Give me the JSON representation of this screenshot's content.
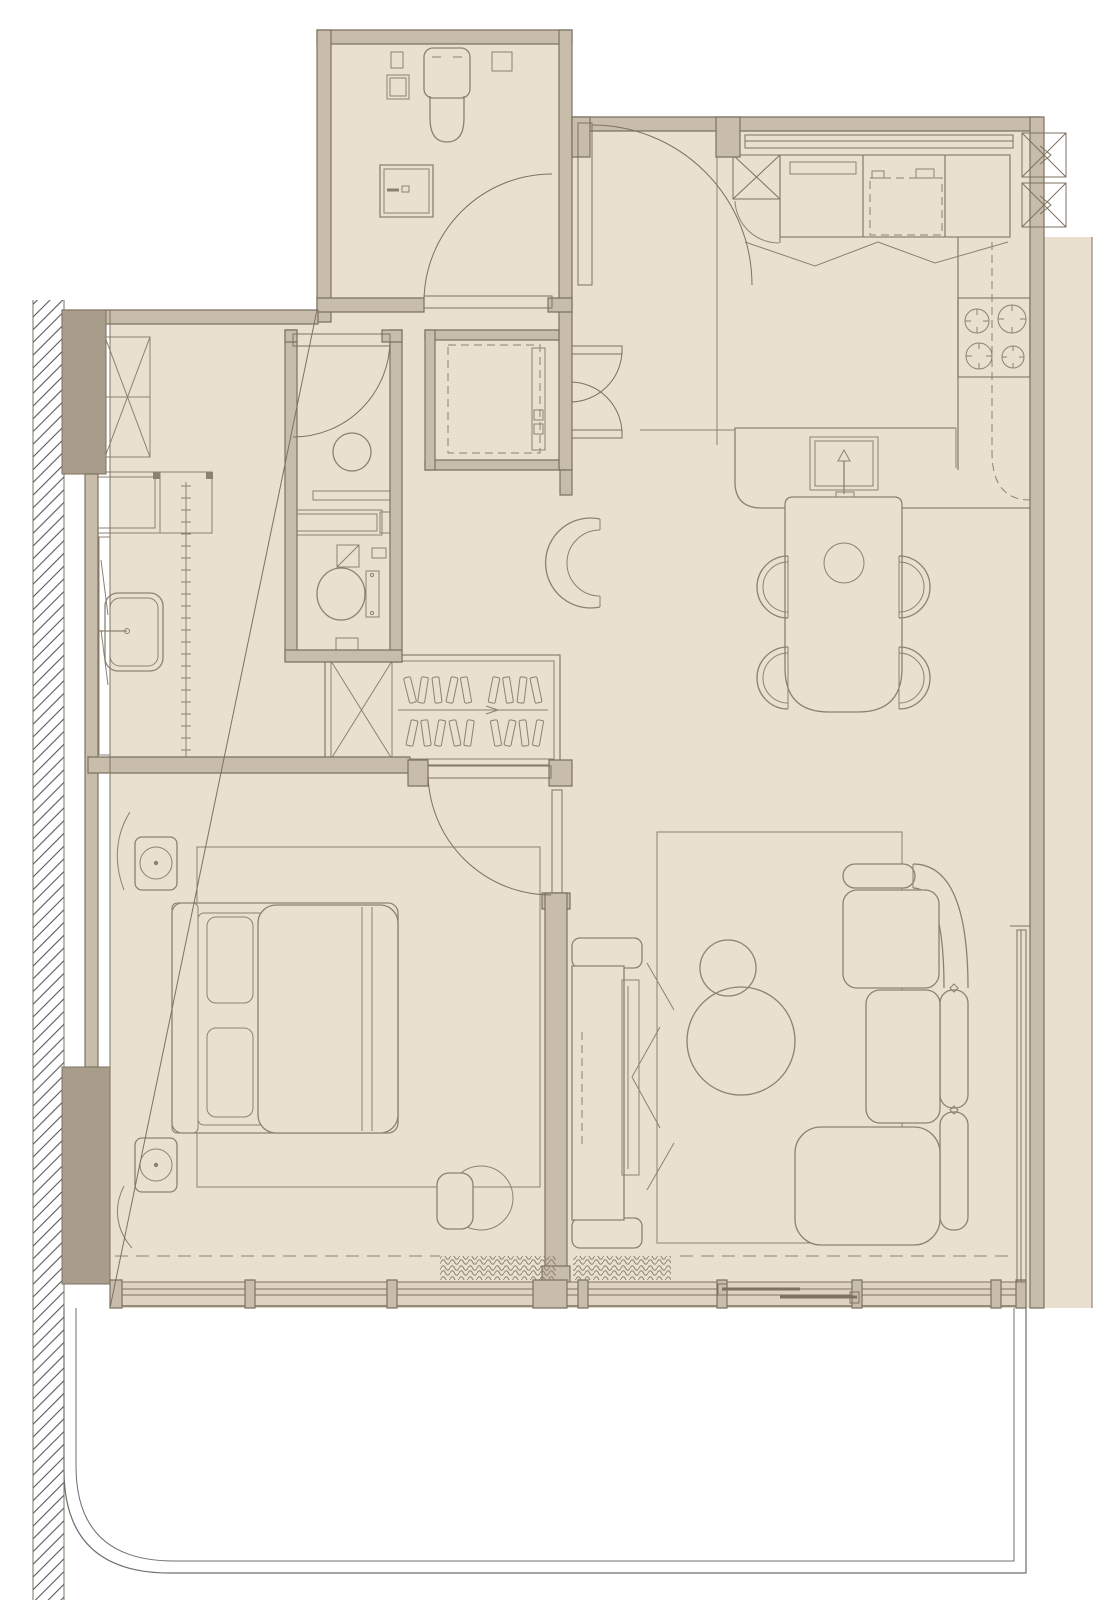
{
  "page": {
    "title": "Apartment floor plan",
    "kind": "architectural-floor-plan",
    "visible_text": []
  },
  "colors": {
    "background": "#ffffff",
    "floor": "#e9e0d0",
    "wall_fill": "#c7bdaa",
    "wall_dark": "#a89d8a",
    "line": "#7d7260",
    "furn": "#8d8270",
    "hatch": "#585858",
    "glass": "#ddd3c0"
  },
  "rooms": [
    "main-bathroom",
    "entry-hall",
    "kitchen",
    "dining-area",
    "ensuite-bathroom",
    "utility-closet",
    "walk-in-wardrobe",
    "dressing-area",
    "bedroom",
    "living-room",
    "balcony"
  ],
  "furniture_icons": [
    "toilet-icon",
    "washbasin-icon",
    "washing-machine-icon",
    "shower-icon",
    "fridge-icon",
    "stove-icon",
    "kitchen-sink-icon",
    "dining-table-icon",
    "dining-chair-icon",
    "armchair-icon",
    "hanger-rail-icon",
    "bed-icon",
    "nightstand-icon",
    "lamp-icon",
    "pouf-icon",
    "stool-icon",
    "tv-console-icon",
    "sofa-icon",
    "coffee-table-icon",
    "rug-icon",
    "curtain-icon",
    "ac-unit-icon",
    "duct-shaft-icon"
  ]
}
